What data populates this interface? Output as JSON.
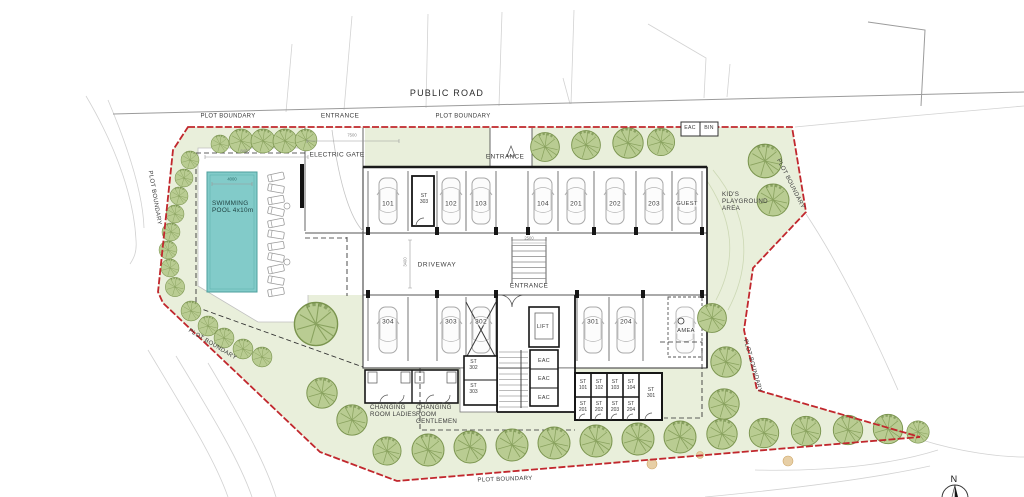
{
  "colors": {
    "boundary": "#c1272d",
    "pool": "#82cbc9",
    "green": "#e9efdb",
    "tree": "#b9cc92",
    "tree_dark": "#7a944e"
  },
  "labels": {
    "public_road": "PUBLIC ROAD",
    "plot_boundary": "PLOT BOUNDARY",
    "entrance": "ENTRANCE",
    "electric_gate": "ELECTRIC GATE",
    "eac": "EAC",
    "bin": "BIN",
    "swimming_pool": "SWIMMING POOL 4x10m",
    "kids_playground": "KID'S PLAYGROUND AREA",
    "driveway": "DRIVEWAY",
    "lift": "LIFT",
    "amea": "AMEA",
    "changing_ladies": "CHANGING ROOM LADIES",
    "changing_gentlemen": "CHANGING ROOM GENTLEMEN",
    "north": "N"
  },
  "parking_top": [
    "101",
    "102",
    "103",
    "104",
    "201",
    "202",
    "203",
    "GUEST"
  ],
  "parking_bottom": [
    "304",
    "303",
    "302",
    "301",
    "204"
  ],
  "storage": {
    "st_upper": "ST 303",
    "st_302": "ST 302",
    "st_303": "ST 303",
    "st_301": "ST 301",
    "row1": [
      "ST 101",
      "ST 102",
      "ST 103",
      "ST 104"
    ],
    "row2": [
      "ST 201",
      "ST 202",
      "ST 203",
      "ST 204"
    ]
  },
  "eac_rooms": [
    "EAC",
    "EAC",
    "EAC"
  ],
  "dimensions": {
    "entrance_width": "7500",
    "deck_width": "8400",
    "pool_width": "4000",
    "driveway_width": "3400",
    "stair_width": "2500"
  }
}
